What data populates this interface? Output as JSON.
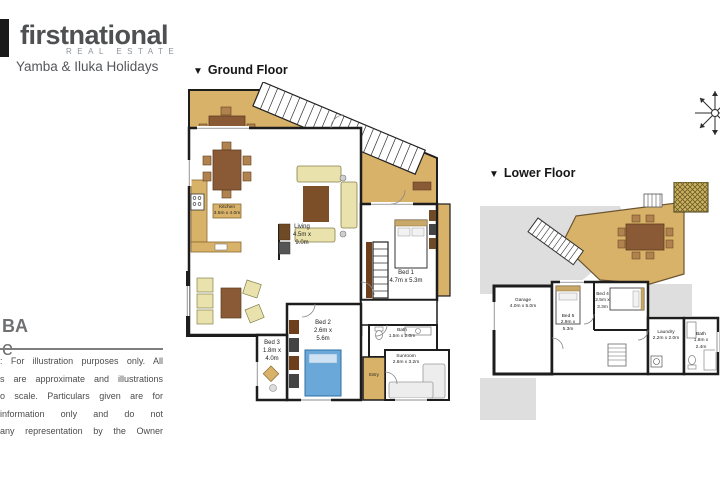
{
  "header": {
    "logo_main": "firstnational",
    "logo_sub": "REAL ESTATE",
    "tagline": "Yamba & Iluka Holidays"
  },
  "left_panel": {
    "cut_line1": "BA",
    "cut_line2": "e",
    "disclaimer": [
      ": For illustration purposes only. All",
      "s are approximate and illustrations",
      "o scale. Particulars given are for",
      "information only and do not",
      "any representation by the Owner"
    ]
  },
  "ground_floor": {
    "marker": "▼",
    "title": "Ground Floor",
    "labels": {
      "living": {
        "name": "Living",
        "dims": "4.5m x 9.0m"
      },
      "kitchen": {
        "name": "Kitchen",
        "dims": "3.5m x 4.0m"
      },
      "bed1": {
        "name": "Bed 1",
        "dims": "4.7m x 5.3m"
      },
      "bed2": {
        "name": "Bed 2",
        "dims": "2.6m x 5.6m"
      },
      "bed3": {
        "name": "Bed 3",
        "dims": "1.8m x 4.0m"
      },
      "bath": {
        "name": "Bath",
        "dims": "1.5m x 2.0m"
      },
      "sunroom": {
        "name": "Sunroom",
        "dims": "2.6m x 3.2m"
      },
      "entry": {
        "name": "Entry",
        "dims": ""
      }
    }
  },
  "lower_floor": {
    "marker": "▼",
    "title": "Lower Floor",
    "labels": {
      "garage": {
        "name": "Garage",
        "dims": "4.0m x 5.0m"
      },
      "bed4": {
        "name": "Bed 4",
        "dims": "2.5m x 3.3m"
      },
      "bed5": {
        "name": "Bed 5",
        "dims": "2.9m x 5.3m"
      },
      "laundry": {
        "name": "Laundry",
        "dims": "2.2m x 2.0m"
      },
      "bath": {
        "name": "Bath",
        "dims": "1.8m x 2.4m"
      }
    }
  },
  "colors": {
    "deck": "#d9b269",
    "timber": "#8a5a36",
    "wall": "#1d1d1d",
    "sofa": "#e9e2ac",
    "rug": "#7d4f28",
    "bed_blue": "#69a8d8",
    "paving": "#dedede",
    "logo_grey": "#4f5052"
  }
}
